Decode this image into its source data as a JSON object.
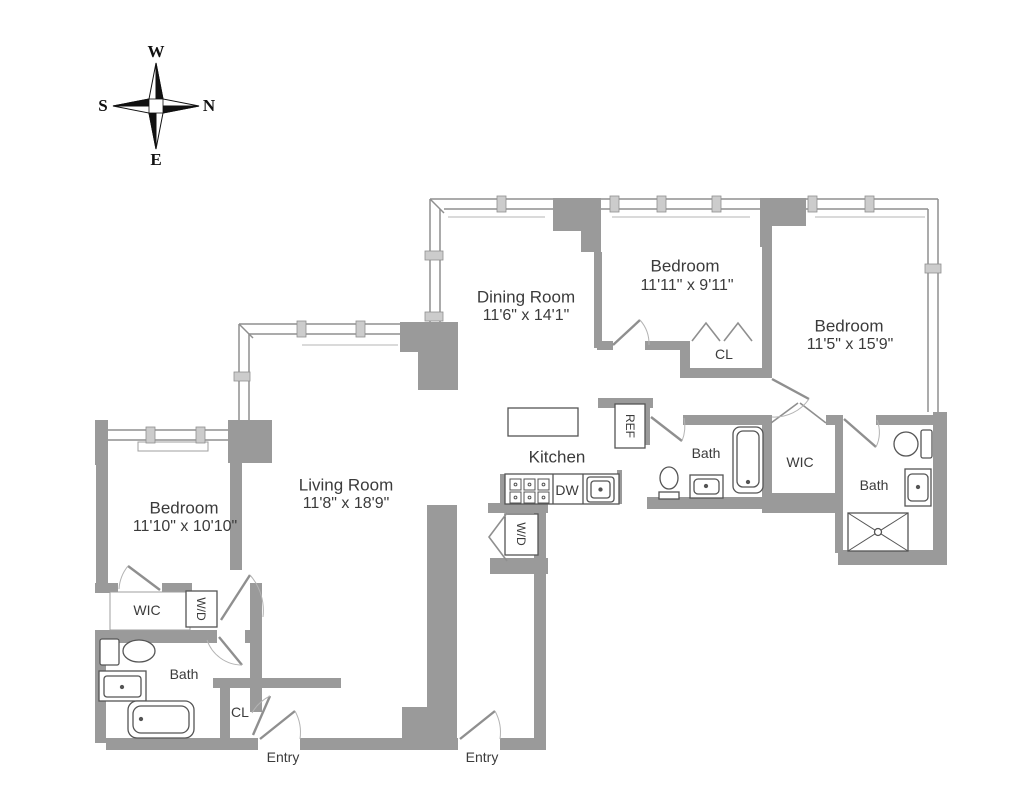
{
  "compass": {
    "w": "W",
    "s": "S",
    "n": "N",
    "e": "E"
  },
  "rooms": {
    "dining": {
      "name": "Dining Room",
      "dims": "11'6\" x 14'1\""
    },
    "bedroom_top": {
      "name": "Bedroom",
      "dims": "11'11\" x 9'11\""
    },
    "bedroom_right": {
      "name": "Bedroom",
      "dims": "11'5\" x 15'9\""
    },
    "bedroom_left": {
      "name": "Bedroom",
      "dims": "11'10\" x 10'10\""
    },
    "living": {
      "name": "Living Room",
      "dims": "11'8\" x 18'9\""
    },
    "kitchen": {
      "name": "Kitchen"
    }
  },
  "labels": {
    "cl_top": "CL",
    "cl_left": "CL",
    "bath_center": "Bath",
    "bath_right": "Bath",
    "bath_left": "Bath",
    "wic_right": "WIC",
    "wic_left": "WIC",
    "ref": "REF",
    "dw": "DW",
    "wd_kitchen": "W/D",
    "wd_left": "W/D",
    "entry_left": "Entry",
    "entry_right": "Entry"
  },
  "colors": {
    "wall": "#9a9a9a",
    "thin_wall": "#8f8f8f",
    "fixture": "#555555",
    "text": "#3b3b3b"
  }
}
